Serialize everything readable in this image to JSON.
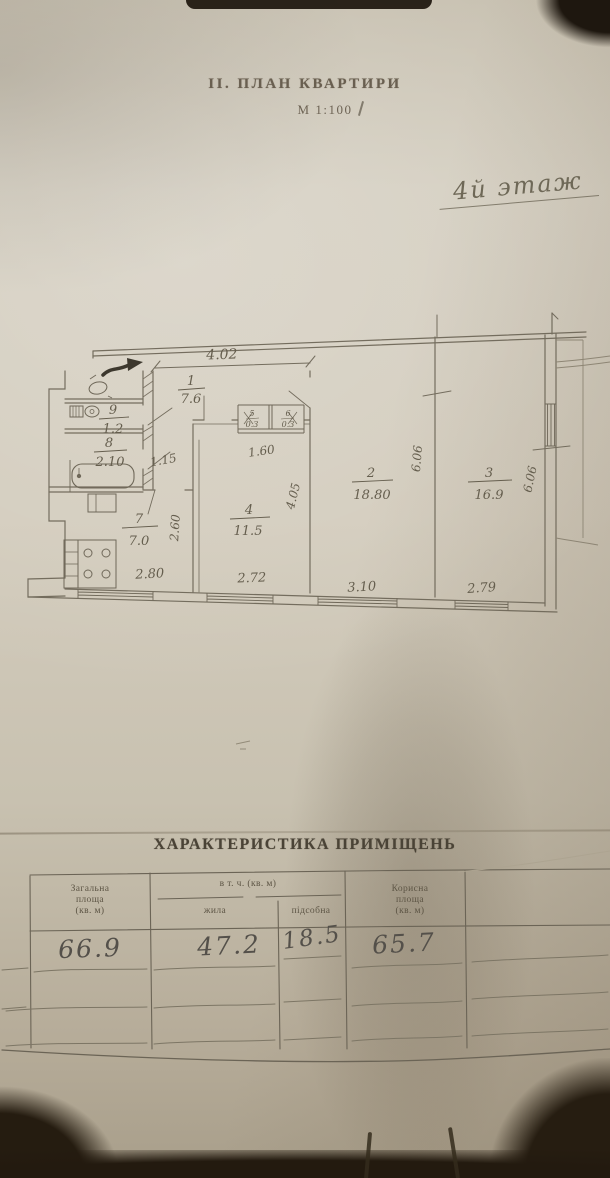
{
  "document": {
    "section_title": "ІІ. ПЛАН КВАРТИРИ",
    "scale": "М 1:100",
    "floor_note": "4й этаж"
  },
  "plan": {
    "rooms": [
      {
        "id": "1",
        "area": "7.6"
      },
      {
        "id": "2",
        "area": "18.80"
      },
      {
        "id": "3",
        "area": "16.9"
      },
      {
        "id": "4",
        "area": "11.5"
      },
      {
        "id": "5",
        "area": "0.3"
      },
      {
        "id": "6",
        "area": "0.3"
      },
      {
        "id": "7",
        "area": "7.0"
      },
      {
        "id": "8",
        "area": "2.10"
      },
      {
        "id": "9",
        "area": "1.2"
      }
    ],
    "dims": {
      "hall_width": "4.02",
      "corridor_width": "1.15",
      "closet_width": "1.60",
      "kitchen_depth": "2.60",
      "kitchen_width": "2.80",
      "room4_width": "2.72",
      "room4_depth": "4.05",
      "room2_width": "3.10",
      "room2_depth": "6.06",
      "room3_width": "2.79",
      "room3_depth": "6.06"
    },
    "symbols": [
      "entrance-arrow",
      "bathtub",
      "toilet",
      "stove",
      "closet",
      "window"
    ]
  },
  "table": {
    "title": "ХАРАКТЕРИСТИКА ПРИМІЩЕНЬ",
    "headers": {
      "total": [
        "Загальна",
        "площа",
        "(кв. м)"
      ],
      "incl": "в т. ч. (кв. м)",
      "living": "жила",
      "aux": "підсобна",
      "useful": [
        "Корисна",
        "площа",
        "(кв. м)"
      ]
    },
    "values": {
      "total": "66.9",
      "living": "47.2",
      "aux": "18.5",
      "useful": "65.7"
    }
  }
}
